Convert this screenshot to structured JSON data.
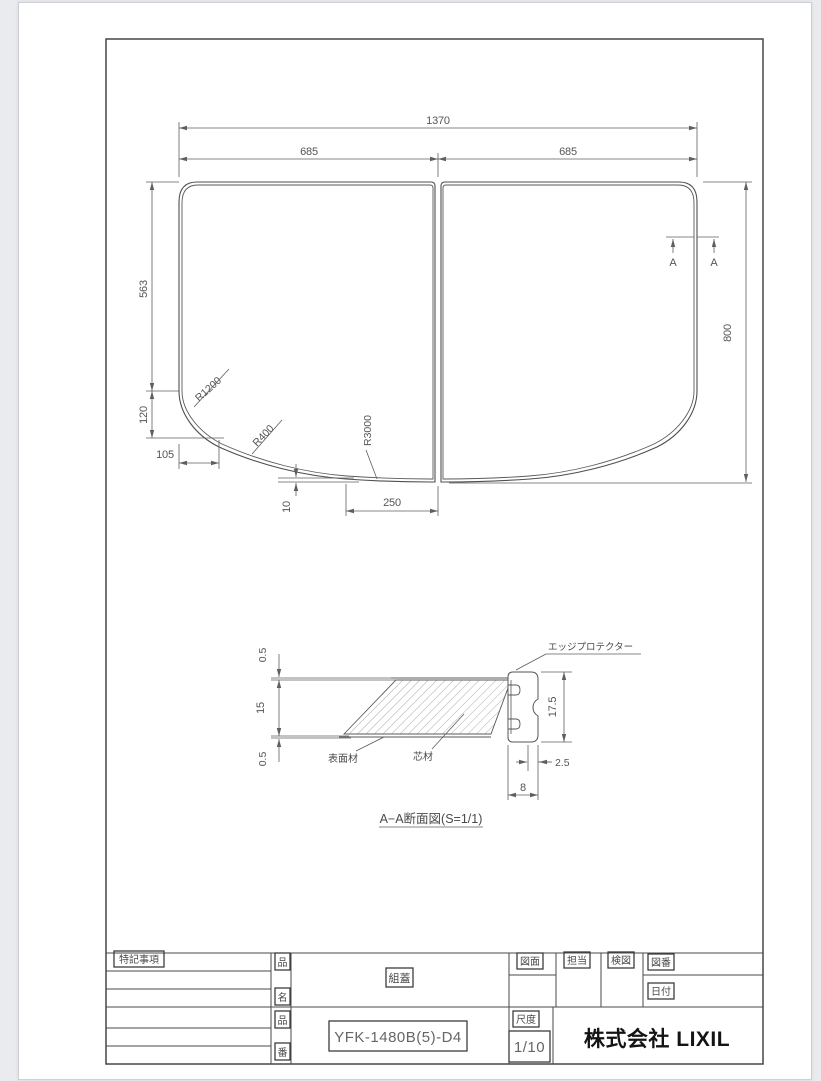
{
  "canvas": {
    "background": "#e9ebee",
    "paper_color": "#ffffff",
    "line_color": "#555555",
    "frame_color": "#474747",
    "logo_color": "#141414"
  },
  "plan": {
    "total_width": "1370",
    "half_left": "685",
    "half_right": "685",
    "height": "800",
    "side_straight": "563",
    "side_drop": "120",
    "side_inset": "105",
    "bottom_rise": "10",
    "bottom_run": "250",
    "r1": "R1200",
    "r2": "R400",
    "r3": "R3000",
    "section_a_left": "A",
    "section_a_right": "A"
  },
  "section": {
    "title": "A−A断面図(S=1/1)",
    "edge_protector": "エッジプロテクター",
    "surface": "表面材",
    "core": "芯材",
    "skin_top": "0.5",
    "core_thk": "15",
    "skin_bot": "0.5",
    "prot_h": "17.5",
    "prot_off": "2.5",
    "prot_w": "8"
  },
  "titleblock": {
    "notes": "特記事項",
    "name1": "品",
    "name2": "名",
    "no1": "品",
    "no2": "番",
    "product_name": "組蓋",
    "product_no": "YFK-1480B(5)-D4",
    "zumen": "図面",
    "tanto": "担当",
    "kenzu": "検図",
    "zuban": "図番",
    "hizuke": "日付",
    "scale_label": "尺度",
    "scale": "1/10",
    "company": "株式会社 LIXIL"
  }
}
